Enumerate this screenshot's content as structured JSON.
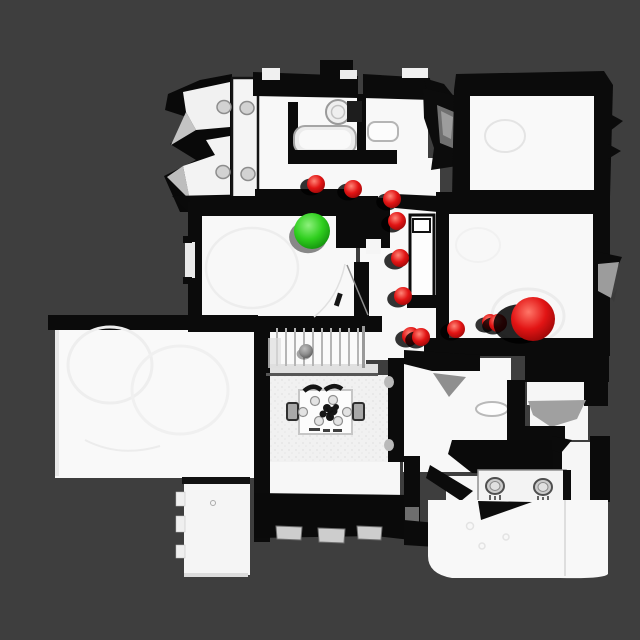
{
  "scene": {
    "background_color": "#3e3e3e",
    "wall_color": "#0b0b0b",
    "floor_color": "#f8f8f8",
    "shadow_color": "#000000",
    "start_marker": {
      "x": 312,
      "y": 231,
      "radius": 18,
      "color": "#2fcf1e",
      "highlight": "#8df07c",
      "edge": "#128f0d"
    },
    "goal_marker": {
      "x": 533,
      "y": 319,
      "radius": 22,
      "color": "#e21414",
      "highlight": "#ff7668",
      "edge": "#970707"
    },
    "waypoint_style": {
      "color": "#e21414",
      "highlight": "#ff8577",
      "edge": "#9c0808",
      "default_radius": 9
    },
    "waypoints": [
      {
        "x": 316,
        "y": 184,
        "radius": 9
      },
      {
        "x": 353,
        "y": 189,
        "radius": 9
      },
      {
        "x": 392,
        "y": 199,
        "radius": 9
      },
      {
        "x": 397,
        "y": 221,
        "radius": 9
      },
      {
        "x": 400,
        "y": 258,
        "radius": 9
      },
      {
        "x": 403,
        "y": 296,
        "radius": 9
      },
      {
        "x": 411,
        "y": 336,
        "radius": 9
      },
      {
        "x": 421,
        "y": 337,
        "radius": 9
      },
      {
        "x": 456,
        "y": 329,
        "radius": 9
      },
      {
        "x": 490,
        "y": 322,
        "radius": 8
      },
      {
        "x": 498,
        "y": 323,
        "radius": 9
      }
    ],
    "object_ball": {
      "x": 306,
      "y": 351,
      "radius": 7,
      "color": "#909090",
      "highlight": "#bdbdbd",
      "edge": "#5a5a5a"
    }
  }
}
